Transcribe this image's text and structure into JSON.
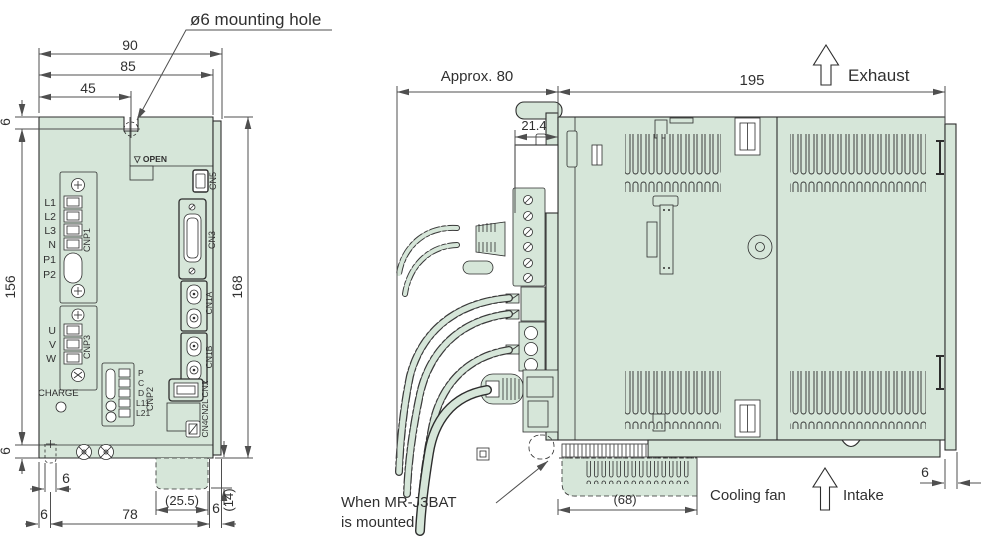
{
  "colors": {
    "body_fill": "#d6e6d9",
    "outline": "#2d2d2d",
    "dimension": "#4f4f4f"
  },
  "front_view": {
    "note_mounting_hole": "ø6 mounting hole",
    "open_label": "▽ OPEN",
    "charge_label": "CHARGE",
    "cnp1": {
      "label": "CNP1",
      "terminals": [
        "L1",
        "L2",
        "L3",
        "N",
        "P1",
        "P2"
      ]
    },
    "cnp3": {
      "label": "CNP3",
      "terminals": [
        "U",
        "V",
        "W"
      ]
    },
    "cnp2": {
      "label": "CNP2",
      "terminals": [
        "P",
        "C",
        "D",
        "L11",
        "L21"
      ]
    },
    "connectors": {
      "cn5": "CN5",
      "cn3": "CN3",
      "cn1a": "CN1A",
      "cn1b": "CN1B",
      "cn2": "CN2",
      "cn2l": "CN2L",
      "cn4": "CN4"
    },
    "dims": {
      "top_total": "90",
      "top_body": "85",
      "top_to_hole": "45",
      "left_top": "6",
      "left_height": "156",
      "left_bottom": "6",
      "right_height": "168",
      "bottom_left": "6",
      "bottom_center": "78",
      "bottom_right": "6",
      "bottom_slot": "6",
      "battery_width": "(25.5)",
      "battery_depth": "(14)"
    }
  },
  "side_view": {
    "labels": {
      "exhaust": "Exhaust",
      "cooling_fan": "Cooling fan",
      "intake": "Intake",
      "battery_note_1": "When MR-J3BAT",
      "battery_note_2": "is mounted"
    },
    "dims": {
      "front_depth": "Approx. 80",
      "cover_step": "21.4",
      "body_depth": "195",
      "battery_width": "(68)",
      "back_gap": "6"
    }
  }
}
